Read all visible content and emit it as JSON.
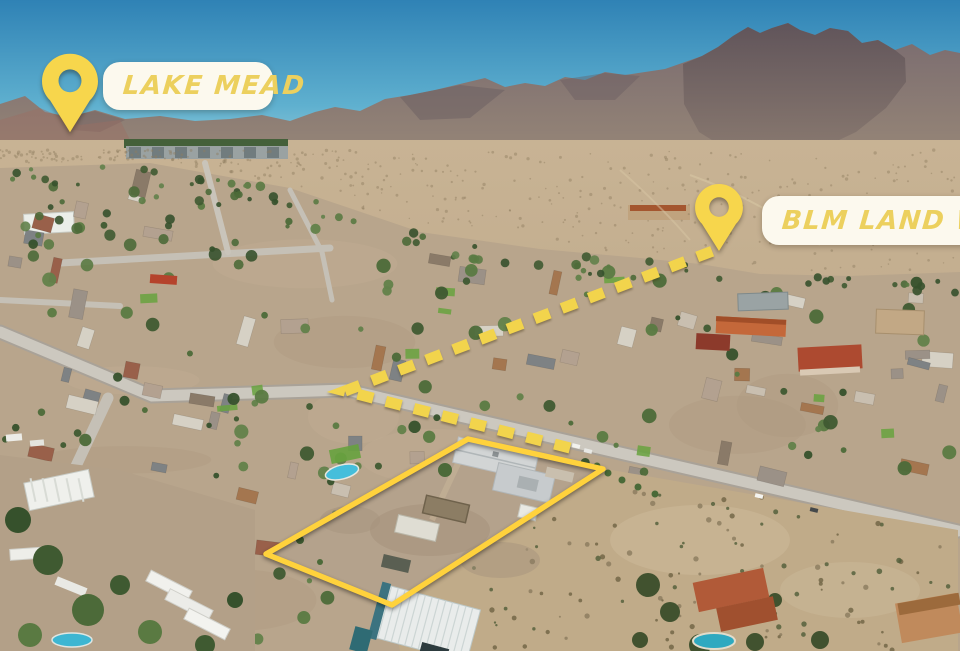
{
  "annotations": {
    "colors": {
      "pin_fill": "#F7D64C",
      "label_text": "#ECD05E",
      "label_bg": "#FCF9EE",
      "parcel_outline": "#FFD23C",
      "route_dash": "#F2D44C"
    },
    "labels": [
      {
        "id": "lake-mead",
        "text": "LAKE MEAD",
        "pin": {
          "x": 70,
          "tip_y": 133,
          "w": 56,
          "h": 80
        },
        "box": {
          "x": 103,
          "y": 62,
          "w": 170,
          "h": 48
        }
      },
      {
        "id": "blm-land",
        "text": "BLM LAND WITH",
        "pin": {
          "x": 719,
          "tip_y": 251,
          "w": 48,
          "h": 67
        },
        "box": {
          "x": 762,
          "y": 196,
          "w": 260,
          "h": 49
        }
      }
    ],
    "parcel_outline": {
      "points": "468,439 603,469 392,605 266,554"
    },
    "route": {
      "path": "M 570 448 L 345 391 L 718 249"
    }
  }
}
